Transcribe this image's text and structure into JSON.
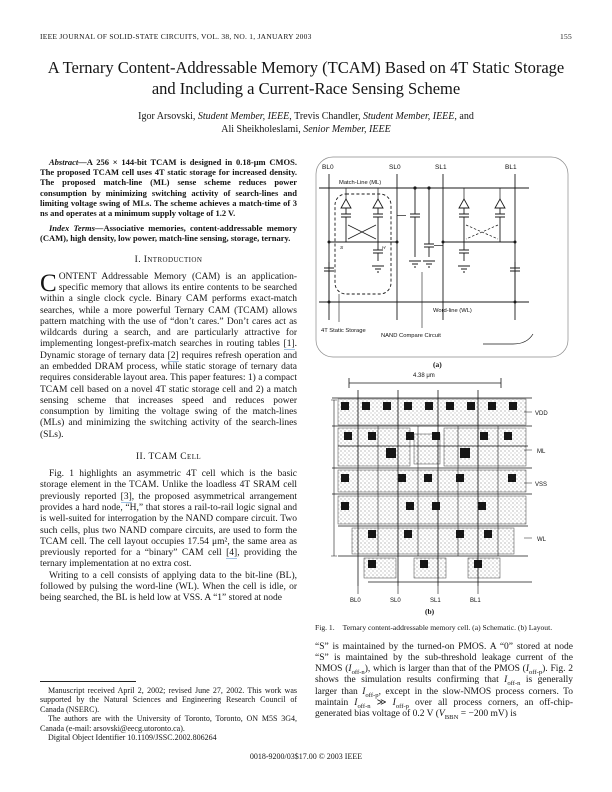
{
  "header": {
    "journal": "IEEE JOURNAL OF SOLID-STATE CIRCUITS, VOL. 38, NO. 1, JANUARY 2003",
    "page_number": "155"
  },
  "title": {
    "line1": "A Ternary Content-Addressable Memory (TCAM) Based on 4T Static Storage",
    "line2": "and Including a Current-Race Sensing Scheme"
  },
  "authors": {
    "a1": "Igor Arsovski, ",
    "a2": "Student Member, IEEE",
    "a3": ", Trevis Chandler, ",
    "a4": "Student Member, IEEE",
    "a5": ", and",
    "b1": "Ali Sheikholeslami, ",
    "b2": "Senior Member, IEEE"
  },
  "abstract": {
    "lead": "Abstract—",
    "text": "A 256 × 144-bit TCAM is designed in 0.18-μm CMOS. The proposed TCAM cell uses 4T static storage for increased density. The proposed match-line (ML) sense scheme reduces power consumption by minimizing switching activity of search-lines and limiting voltage swing of MLs. The scheme achieves a match-time of 3 ns and operates at a minimum supply voltage of 1.2 V."
  },
  "index_terms": {
    "lead": "Index Terms—",
    "text": "Associative memories, content-addressable memory (CAM), high density, low power, match-line sensing, storage, ternary."
  },
  "headings": {
    "intro": "I. Introduction",
    "tcam": "II. TCAM Cell"
  },
  "intro": {
    "dropcap": "C",
    "p1a": "ONTENT Addressable Memory (CAM) is an application-specific memory that allows its entire contents to be searched within a single clock cycle. Binary CAM performs exact-match searches, while a more powerful Ternary CAM (TCAM) allows pattern matching with the use of “don’t cares.” Don’t cares act as wildcards during a search, and are particularly attractive for implementing longest-prefix-match searches in routing tables ",
    "cite1": "[1]",
    "p1b": ". Dynamic storage of ternary data ",
    "cite2": "[2]",
    "p1c": " requires refresh operation and an embedded DRAM process, while static storage of ternary data requires considerable layout area. This paper features: 1) a compact TCAM cell based on a novel 4T static storage cell and 2) a match sensing scheme that increases speed and reduces power consumption by limiting the voltage swing of the match-lines (MLs) and minimizing the switching activity of the search-lines (SLs)."
  },
  "tcam": {
    "p1a": "Fig. 1 highlights an asymmetric 4T cell which is the basic storage element in the TCAM. Unlike the loadless 4T SRAM cell previously reported ",
    "cite3": "[3]",
    "p1b": ", the proposed asymmetrical arrangement provides a hard node, “H,” that stores a rail-to-rail logic signal and is well-suited for interrogation by the NAND compare circuit. Two such cells, plus two NAND compare circuits, are used to form the TCAM cell. The cell layout occupies 17.54 μm², the same area as previously reported for a “binary” CAM cell ",
    "cite4": "[4]",
    "p1c": ", providing the ternary implementation at no extra cost.",
    "p2": "Writing to a cell consists of applying data to the bit-line (BL), followed by pulsing the word-line (WL). When the cell is idle, or being searched, the BL is held low at VSS. A “1” stored at node"
  },
  "footnote": {
    "f1": "Manuscript received April 2, 2002; revised June 27, 2002. This work was supported by the Natural Sciences and Engineering Research Council of Canada (NSERC).",
    "f2": "The authors are with the University of Toronto, Toronto, ON M5S 3G4, Canada (e-mail: arsovski@eecg.utoronto.ca).",
    "f3": "Digital Object Identifier 10.1109/JSSC.2002.806264"
  },
  "figure": {
    "schematic": {
      "bl0": "BL0",
      "sl0": "SL0",
      "sl1": "SL1",
      "bl1": "BL1",
      "ml_label": "Match-Line (ML)",
      "wl_label": "Word-line (WL)",
      "node_s": "S",
      "node_h": "H",
      "storage_label": "4T Static Storage",
      "nand_label": "NAND Compare Circuit",
      "sub_label": "(a)"
    },
    "layout": {
      "dim_label": "4.38 μm",
      "right_labels": [
        "VDD",
        "ML",
        "VSS",
        "WL"
      ],
      "bottom_labels": [
        "BL0",
        "SL0",
        "SL1",
        "BL1"
      ],
      "sub_label": "(b)"
    },
    "caption_lead": "Fig. 1.",
    "caption": "Ternary content-addressable memory cell. (a) Schematic. (b) Layout."
  },
  "right_col": {
    "a": "“S” is maintained by the turned-on PMOS. A “0” stored at node “S” is maintained by the sub-threshold leakage current of the NMOS (",
    "v1": "I",
    "s1": "off-n",
    "b": "), which is larger than that of the PMOS (",
    "v2": "I",
    "s2": "off-p",
    "c": "). Fig. 2 shows the simulation results confirming that ",
    "v3": "I",
    "s3": "off-n",
    "d": " is generally larger than ",
    "v4": "I",
    "s4": "off-p",
    "e": ", except in the slow-NMOS process corners. To maintain ",
    "v5": "I",
    "s5": "off-n",
    "f": " ≫ ",
    "v6": "I",
    "s6": "off-p",
    "g": " over all process corners, an off-chip-generated bias voltage of 0.2 V (",
    "v7": "V",
    "s7": "BBN",
    "h": " = −200 mV) is"
  },
  "footer": {
    "text": "0018-9200/03$17.00 © 2003 IEEE"
  },
  "colors": {
    "citation_underline": "#9fc2e6",
    "ink": "#141414"
  }
}
